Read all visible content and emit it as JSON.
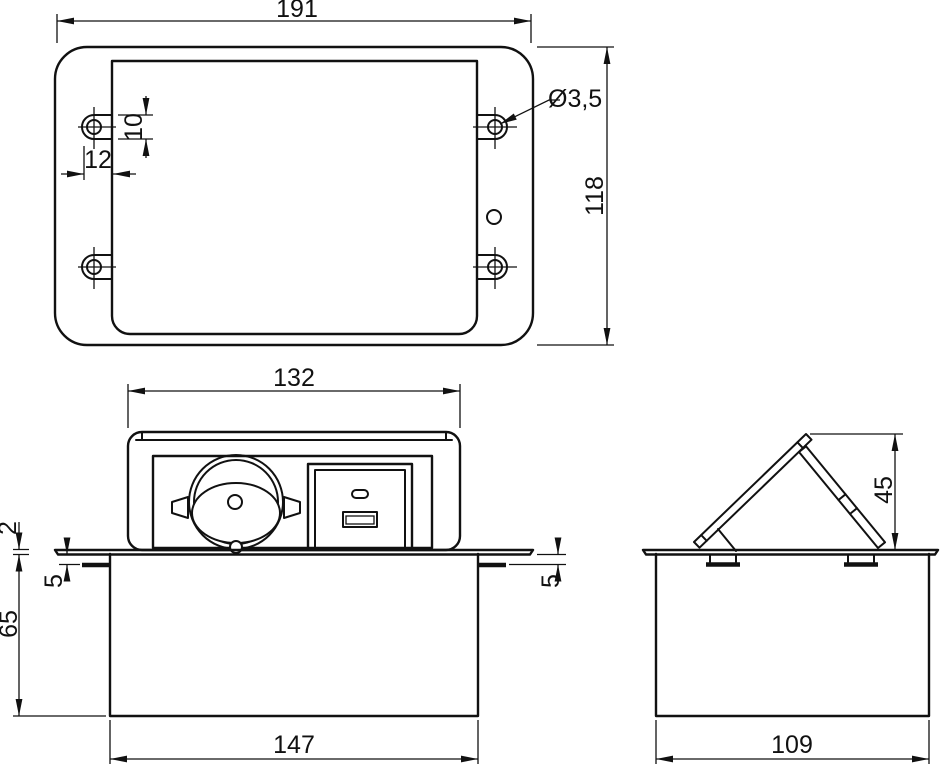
{
  "meta": {
    "type": "technical-drawing",
    "subject": "pop-up tabletop socket unit with Schuko outlet and USB module",
    "units": "mm"
  },
  "colors": {
    "line": "#111111",
    "background": "#ffffff"
  },
  "views": {
    "top": {
      "name": "top view - mounting flange with screw tabs",
      "dims": {
        "overall_width": "191",
        "overall_height": "118",
        "hole_diameter": "Ø3,5",
        "hole_tab_height": "10",
        "hole_tab_offset": "12"
      }
    },
    "front": {
      "name": "front view - unit popped up above tabletop",
      "dims": {
        "head_width": "132",
        "flange_thickness": "2",
        "clamp_gap_left": "5",
        "clamp_gap_right": "5",
        "box_depth": "65",
        "box_width": "147"
      }
    },
    "side": {
      "name": "side view - lid open",
      "dims": {
        "lid_open_height": "45",
        "box_width": "109"
      }
    }
  }
}
